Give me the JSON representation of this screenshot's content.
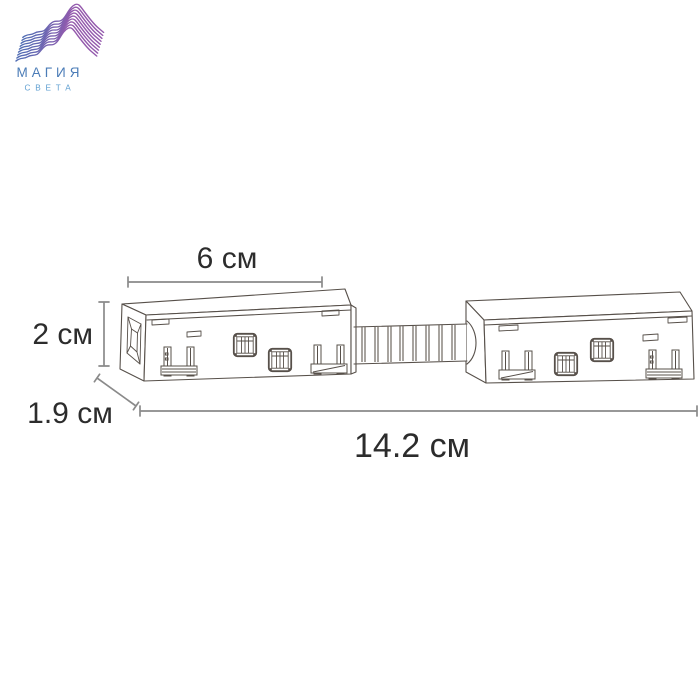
{
  "brand": {
    "title": "МАГИЯ",
    "subtitle": "СВЕТА",
    "mark": "wave-lines-mountain-logo",
    "title_color": "#4b7cb7",
    "subtitle_color": "#5f9fd1",
    "gradient_start": "#4e6db4",
    "gradient_mid": "#8a5cae",
    "gradient_end": "#b54fa7"
  },
  "drawing": {
    "description": "dimensioned-line-drawing-of-flexible-connector-two-blocks-with-corrugated-tube",
    "line_color": "#57504a",
    "dimension_line_color": "#8a8a8a",
    "dimension_text_color": "#2c2c2c",
    "dimensions": {
      "block_width": "6 см",
      "block_height": "2 см",
      "block_depth": "1.9 см",
      "overall_length": "14.2 см"
    }
  }
}
